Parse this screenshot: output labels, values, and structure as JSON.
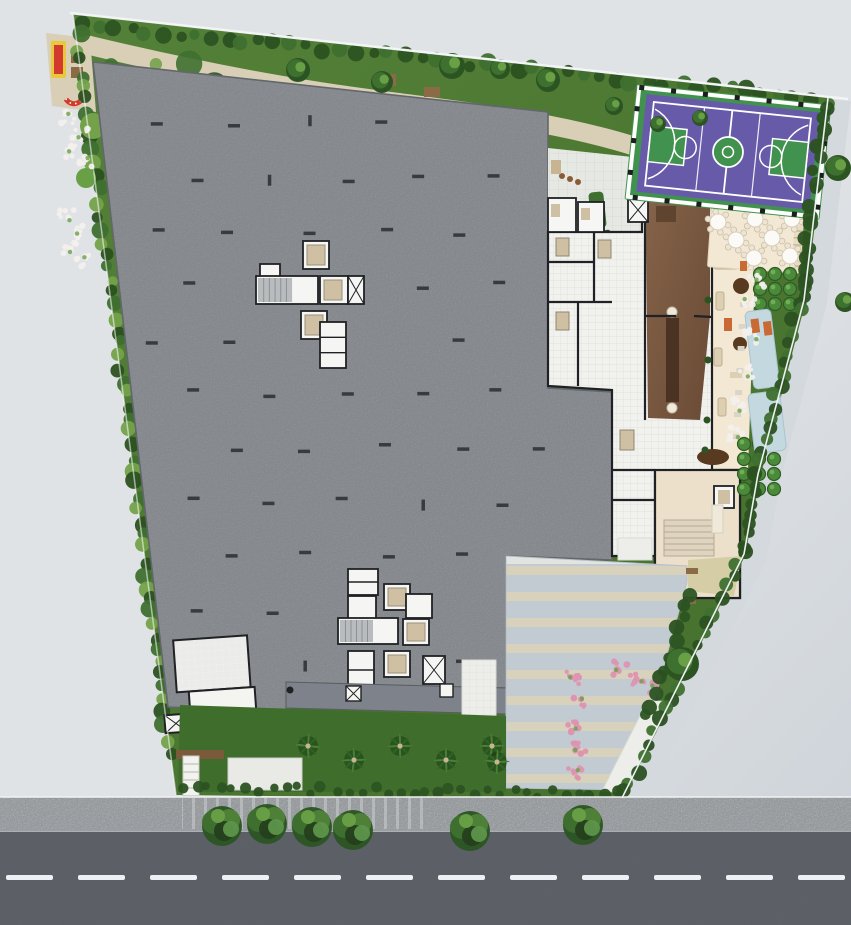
{
  "scene": {
    "kind": "architectural-site-plan-render",
    "visible_text": []
  },
  "colors": {
    "surroundings": "#dfe2e5",
    "surroundings_dark": "#c9cfd6",
    "boundary_line": "#f2f4f6",
    "perimeter_walk": "#d4d9dd",
    "site_green": "#4d7b33",
    "site_green_dark": "#41682a",
    "hedge_dark": "#2b5121",
    "hedge_mid": "#3f7030",
    "shrub_light": "#74a24b",
    "lawn": "#3f6e2c",
    "path_beige": "#d8cfb6",
    "slab_gray": "#9da1a7",
    "slab_edge": "#63666b",
    "slab_dark": "#7e828a",
    "tick_dark": "#2b2d30",
    "core_white": "#f5f5f3",
    "wall_black": "#202124",
    "elevator_tan": "#cfc0a4",
    "stair_gray": "#b9bcbe",
    "floor_white": "#f1f1ee",
    "floor_grid": "#d9d9d5",
    "paving_light": "#e6e8e4",
    "wood_floor": "#7b5940",
    "wood_floor_dark": "#6a4b35",
    "counter_dark": "#4a3323",
    "terrace_cream": "#f3e8d4",
    "hall_beige": "#ece0ca",
    "furniture_tan": "#ddcfb2",
    "accent_orange": "#c96a35",
    "table_dark_brown": "#573a20",
    "court_green": "#42924f",
    "court_purple": "#665aa9",
    "court_line": "#ffffff",
    "water_blue": "#c4d8e0",
    "paver_blue_gray": "#c2cad2",
    "paver_beige": "#d8d2bd",
    "walk_white": "#edeeea",
    "flower_pink": "#dd93b0",
    "flower_white": "#f2efed",
    "play_red": "#d23a2e",
    "play_yellow": "#e9c93b",
    "bench_brown": "#8b6b46",
    "soil_brown": "#7a5a3a",
    "tree_dark": "#2c5423",
    "tree_mid": "#3e7030",
    "tree_light": "#69a046",
    "palm_green": "#2d6526",
    "palm_green_light": "#478234",
    "trunk_tan": "#c6b492",
    "road_asphalt": "#575c63",
    "road_dash": "#eef1f3",
    "sidewalk": "#c8cbcd",
    "curb": "#9ba0a5"
  },
  "features": {
    "surroundings": {
      "name": "neighboring-lots"
    },
    "street": {
      "name": "asphalt-road",
      "center_dash_count": 12
    },
    "sidewalk": {
      "name": "concrete-sidewalk"
    },
    "street_trees": {
      "count": 6
    },
    "site": {
      "name": "landscaped-grounds"
    },
    "playground": {
      "items": [
        "play-mat-red-yellow",
        "curved-play-tunnel",
        "benches"
      ]
    },
    "walking_path": {
      "name": "gravel-path"
    },
    "parking_deck": {
      "name": "parking-deck-roof-slab",
      "elevator_core_clusters": 2
    },
    "tower_floor": {
      "name": "ground-floor-plan"
    },
    "party_room": {
      "name": "wood-floor-party-room"
    },
    "dining_terrace": {
      "table_count": 7
    },
    "basketball_court": {
      "name": "multi-sport-court",
      "surface": "purple",
      "apron": "green"
    },
    "formal_garden": {
      "bush_grids": 2
    },
    "water_feature": {
      "pools": 2
    },
    "driveway": {
      "stripe_count": 9
    },
    "palm_row": {
      "count": 5
    },
    "flower_clusters": {
      "white": 14,
      "pink": 8
    }
  }
}
